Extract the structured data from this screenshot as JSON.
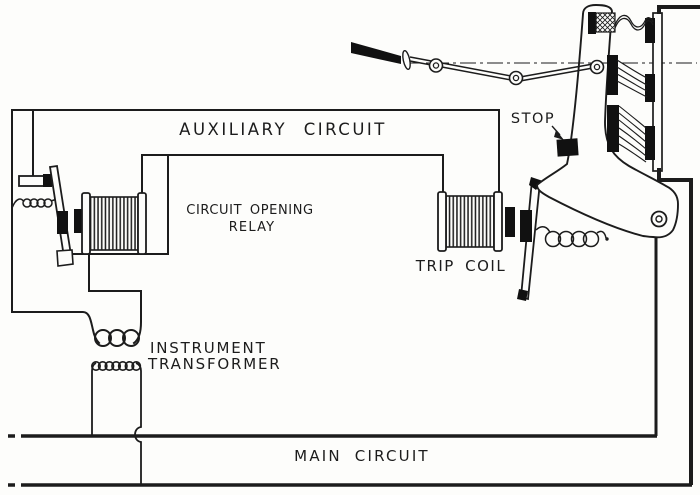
{
  "figure": {
    "type": "electrical schematic (halftone book figure)",
    "colors": {
      "background": "#fdfdfb",
      "ink": "#1c1c1c",
      "contact_black": "#111111"
    },
    "labels": {
      "auxiliary_circuit": "AUXILIARY CIRCUIT",
      "relay_line1": "CIRCUIT OPENING",
      "relay_line2": "RELAY",
      "trip_coil": "TRIP COIL",
      "stop": "STOP",
      "transformer_line1": "INSTRUMENT",
      "transformer_line2": "TRANSFORMER",
      "main_circuit": "MAIN CIRCUIT"
    },
    "components": [
      "operating-handle-and-linkage",
      "circuit-breaker-arm",
      "stationary-contact-panel",
      "laminated-brushes",
      "stop-block",
      "trip-coil",
      "trip-latch-rod",
      "latch-spring",
      "circuit-opening-relay-coil",
      "relay-armature",
      "relay-spring",
      "relay-stationary-contact",
      "instrument-transformer",
      "auxiliary-circuit-wiring",
      "main-circuit-bus"
    ]
  }
}
